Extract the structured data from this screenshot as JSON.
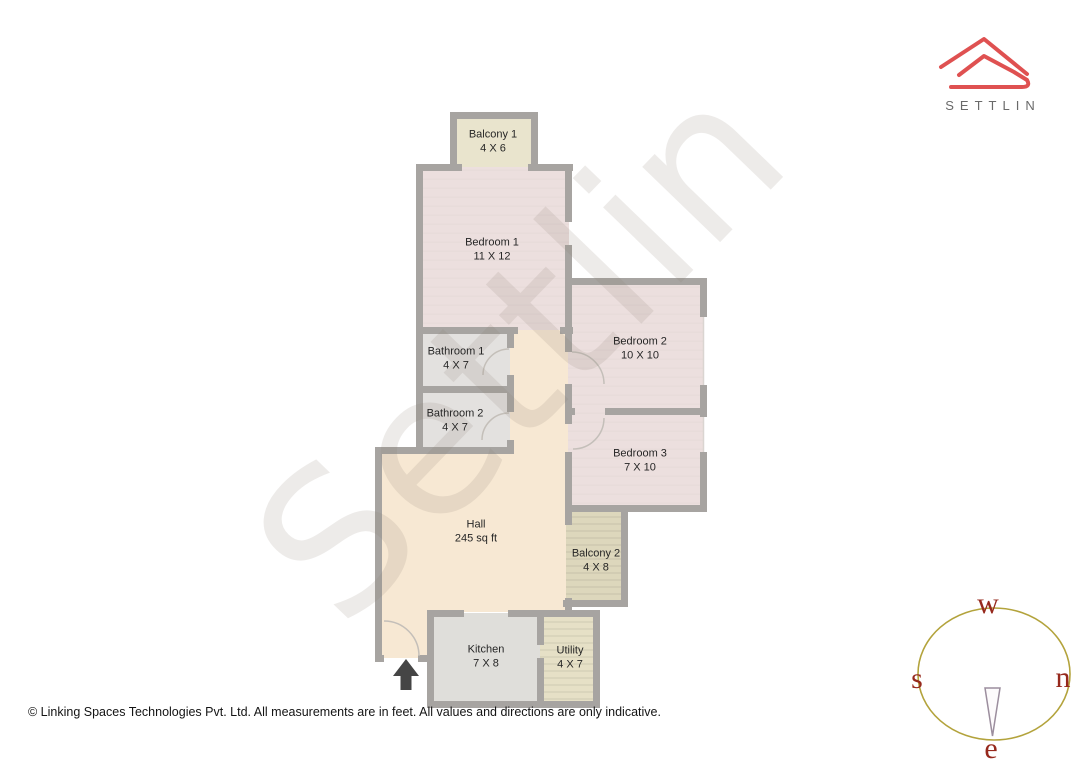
{
  "brand": {
    "wordmark": "SETTLIN"
  },
  "watermark_text": "Settlin",
  "rooms": [
    {
      "name": "Balcony 1",
      "size": "4 X 6"
    },
    {
      "name": "Bedroom 1",
      "size": "11 X 12"
    },
    {
      "name": "Bedroom 2",
      "size": "10 X 10"
    },
    {
      "name": "Bathroom 1",
      "size": "4 X 7"
    },
    {
      "name": "Bathroom 2",
      "size": "4 X 7"
    },
    {
      "name": "Bedroom 3",
      "size": "7 X 10"
    },
    {
      "name": "Hall",
      "size": "245 sq ft"
    },
    {
      "name": "Balcony 2",
      "size": "4 X 8"
    },
    {
      "name": "Kitchen",
      "size": "7 X 8"
    },
    {
      "name": "Utility",
      "size": "4 X 7"
    }
  ],
  "compass": {
    "top": "w",
    "left": "s",
    "right": "n",
    "bottom": "e"
  },
  "footer": {
    "text": "© Linking Spaces Technologies Pvt. Ltd. All measurements are in feet. All values and directions are only indicative."
  },
  "palette": {
    "wall": "#a7a4a1",
    "bedroom_fill": "#ecdfde",
    "bathroom_fill": "#e3e1df",
    "kitchen_fill": "#dfdeda",
    "hall_fill": "#f7e8d3",
    "balcony1_fill": "#e9e4cd",
    "balcony2_fill": "#ddd7bc",
    "utility_fill": "#e6e0c6",
    "logo_red": "#df5151",
    "brand_text_gray": "#6a6a6a",
    "compass_ring": "#b3a33c",
    "compass_letters": "#96291d",
    "entrance_arrow": "#454545"
  }
}
